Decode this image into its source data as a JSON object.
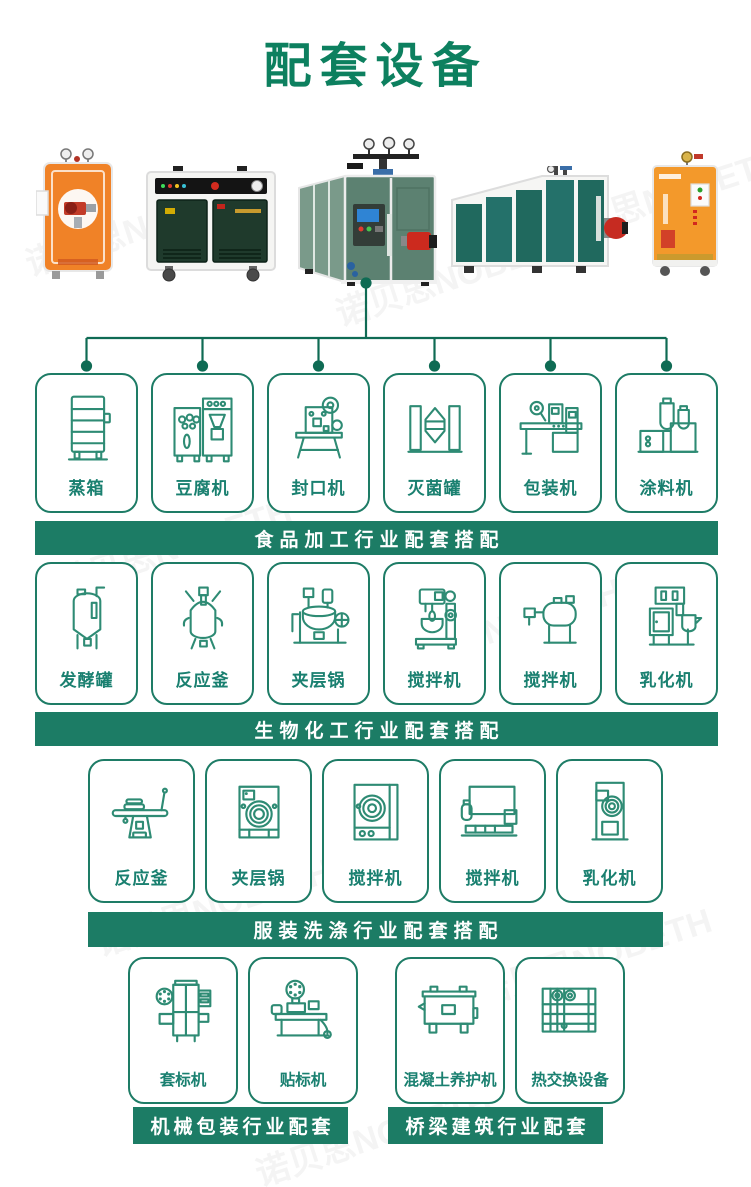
{
  "title": "配套设备",
  "watermark": {
    "text": "诺贝思NOBETH"
  },
  "colors": {
    "title_green": "#0d805f",
    "banner_green": "#1c7c65",
    "icon_stroke_green": "#2e8b74",
    "connector_green": "#0f6b54",
    "label_green": "#1a8070",
    "boiler_orange": "#f08227",
    "boiler_dark_green": "#1f3a2c",
    "boiler_sage_green": "#5c8171",
    "boiler_teal": "#20695e",
    "burner_red": "#c62b21"
  },
  "products": [
    {
      "icon": "vertical-orange-steam-boiler-photo"
    },
    {
      "icon": "green-cabinet-steam-generator-photo"
    },
    {
      "icon": "cube-steam-boiler-photo"
    },
    {
      "icon": "horizontal-steam-boiler-photo"
    },
    {
      "icon": "orange-electric-steam-boiler-photo"
    }
  ],
  "sections": [
    {
      "banner": "食品加工行业配套搭配",
      "items": [
        {
          "label": "蒸箱",
          "icon": "steam-cabinet-icon"
        },
        {
          "label": "豆腐机",
          "icon": "tofu-machine-icon"
        },
        {
          "label": "封口机",
          "icon": "sealing-machine-icon"
        },
        {
          "label": "灭菌罐",
          "icon": "sterilizer-tank-icon"
        },
        {
          "label": "包装机",
          "icon": "packing-machine-icon"
        },
        {
          "label": "涂料机",
          "icon": "coating-machine-icon"
        }
      ]
    },
    {
      "banner": "生物化工行业配套搭配",
      "items": [
        {
          "label": "发酵罐",
          "icon": "fermentation-tank-icon"
        },
        {
          "label": "反应釜",
          "icon": "reaction-kettle-icon"
        },
        {
          "label": "夹层锅",
          "icon": "jacketed-kettle-icon"
        },
        {
          "label": "搅拌机",
          "icon": "planetary-mixer-icon"
        },
        {
          "label": "搅拌机",
          "icon": "horizontal-mixer-icon"
        },
        {
          "label": "乳化机",
          "icon": "emulsifier-icon"
        }
      ]
    },
    {
      "banner": "服装洗涤行业配套搭配",
      "items": [
        {
          "label": "反应釜",
          "icon": "ironing-table-icon"
        },
        {
          "label": "夹层锅",
          "icon": "industrial-washer-icon"
        },
        {
          "label": "搅拌机",
          "icon": "industrial-dryer-icon"
        },
        {
          "label": "搅拌机",
          "icon": "dry-cleaning-machine-icon"
        },
        {
          "label": "乳化机",
          "icon": "tumble-dryer-icon"
        }
      ]
    },
    {
      "banner": "机械包装行业配套",
      "items": [
        {
          "label": "套标机",
          "icon": "sleeve-labeling-machine-icon"
        },
        {
          "label": "贴标机",
          "icon": "labeling-machine-icon"
        }
      ]
    },
    {
      "banner": "桥梁建筑行业配套",
      "items": [
        {
          "label": "混凝土养护机",
          "icon": "concrete-curing-machine-icon"
        },
        {
          "label": "热交换设备",
          "icon": "heat-exchanger-icon"
        }
      ]
    }
  ]
}
